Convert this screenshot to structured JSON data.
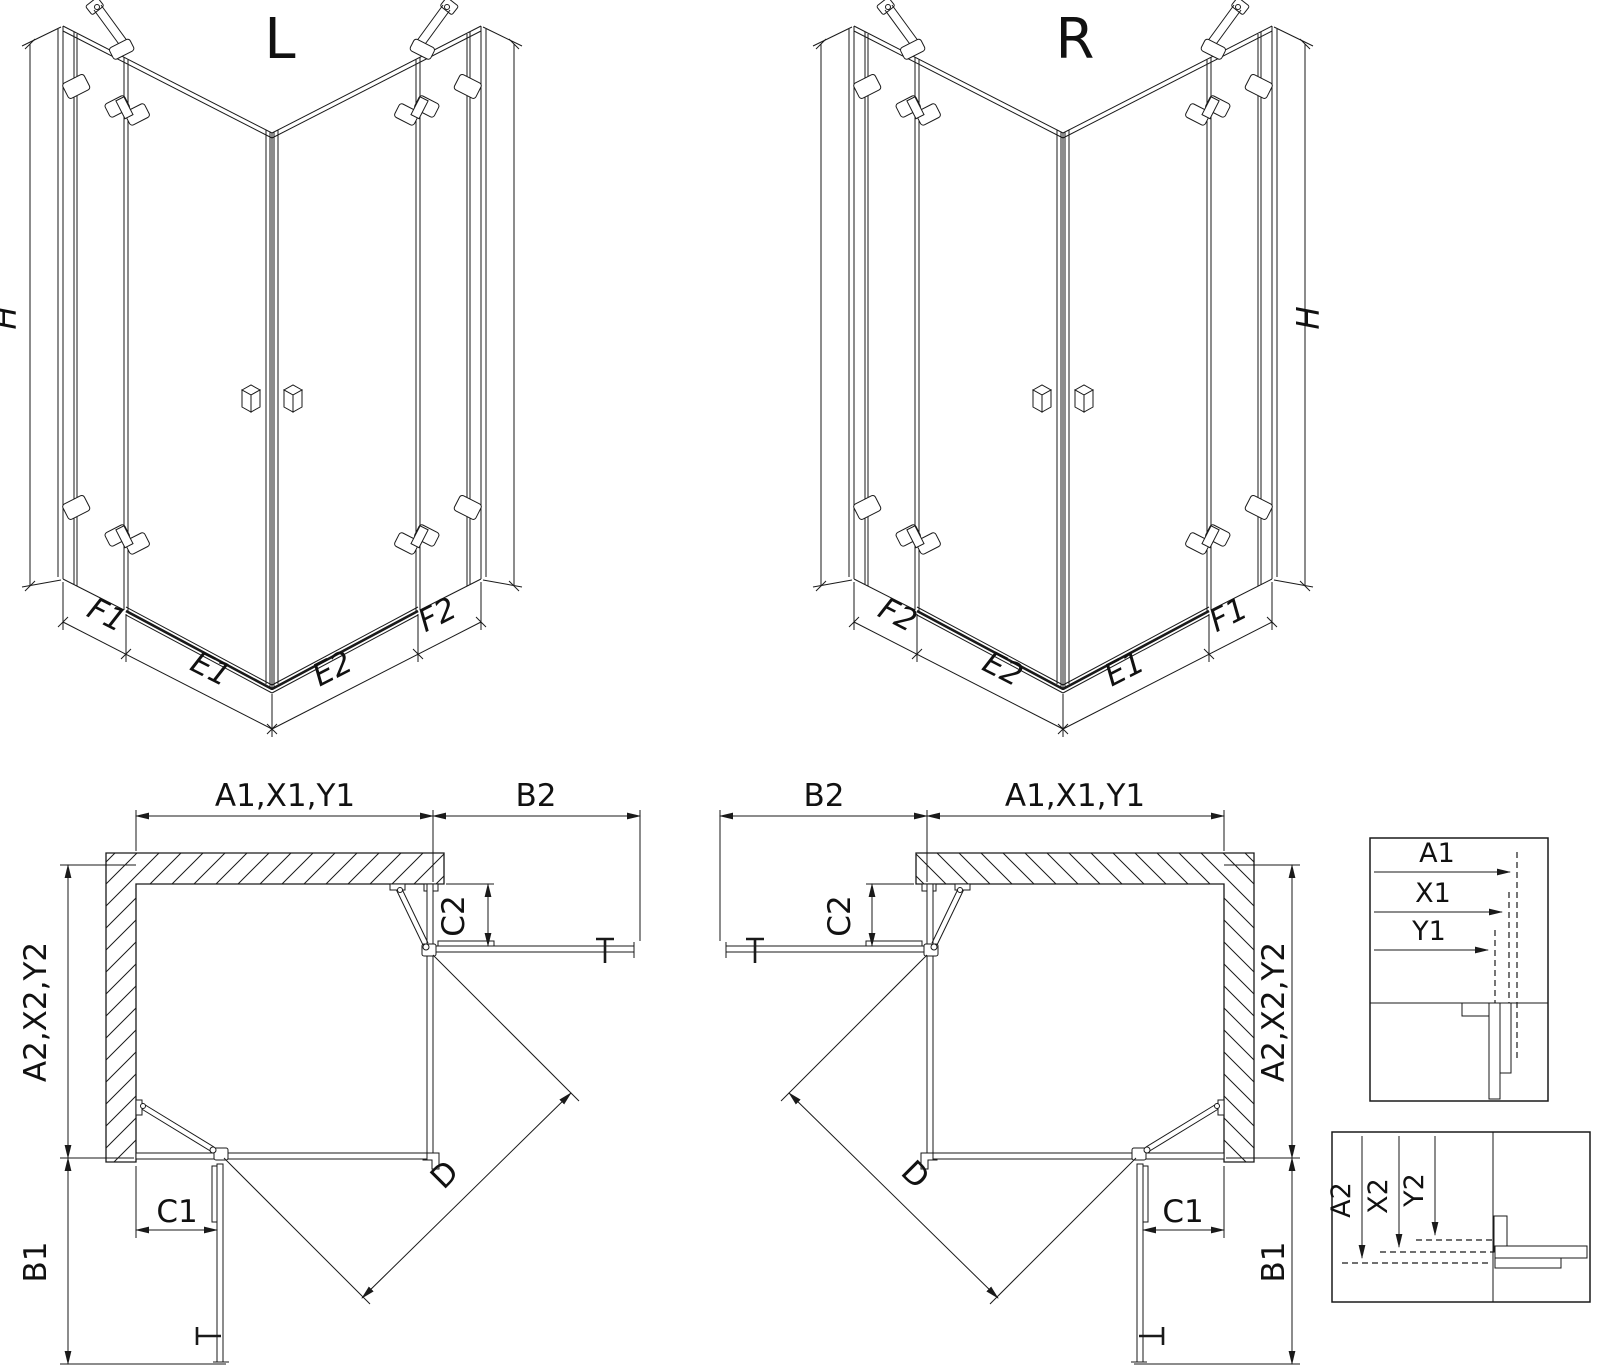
{
  "drawing": {
    "background": "#ffffff",
    "line_color": "#1a1a1a"
  },
  "iso_views": {
    "left": {
      "title": "L",
      "dim_height": "H",
      "dim_fixed_left": "F1",
      "dim_door_left": "E1",
      "dim_door_right": "E2",
      "dim_fixed_right": "F2"
    },
    "right": {
      "title": "R",
      "dim_height": "H",
      "dim_fixed_left": "F2",
      "dim_door_left": "E2",
      "dim_door_right": "E1",
      "dim_fixed_right": "F1"
    }
  },
  "plan_views": {
    "left": {
      "dim_width_top": "A1,X1,Y1",
      "dim_door_projection_top": "B2",
      "dim_width_side": "A2,X2,Y2",
      "dim_door_projection_side": "B1",
      "dim_fixed_panel_door_side": "C2",
      "dim_fixed_panel_wall_side": "C1",
      "dim_diagonal_entry": "D"
    },
    "right": {
      "dim_width_top": "A1,X1,Y1",
      "dim_door_projection_top": "B2",
      "dim_width_side": "A2,X2,Y2",
      "dim_door_projection_side": "B1",
      "dim_fixed_panel_door_side": "C2",
      "dim_fixed_panel_wall_side": "C1",
      "dim_diagonal_entry": "D"
    }
  },
  "detail_views": {
    "horizontal": {
      "labels": [
        "A1",
        "X1",
        "Y1"
      ]
    },
    "vertical": {
      "labels": [
        "A2",
        "X2",
        "Y2"
      ]
    }
  }
}
